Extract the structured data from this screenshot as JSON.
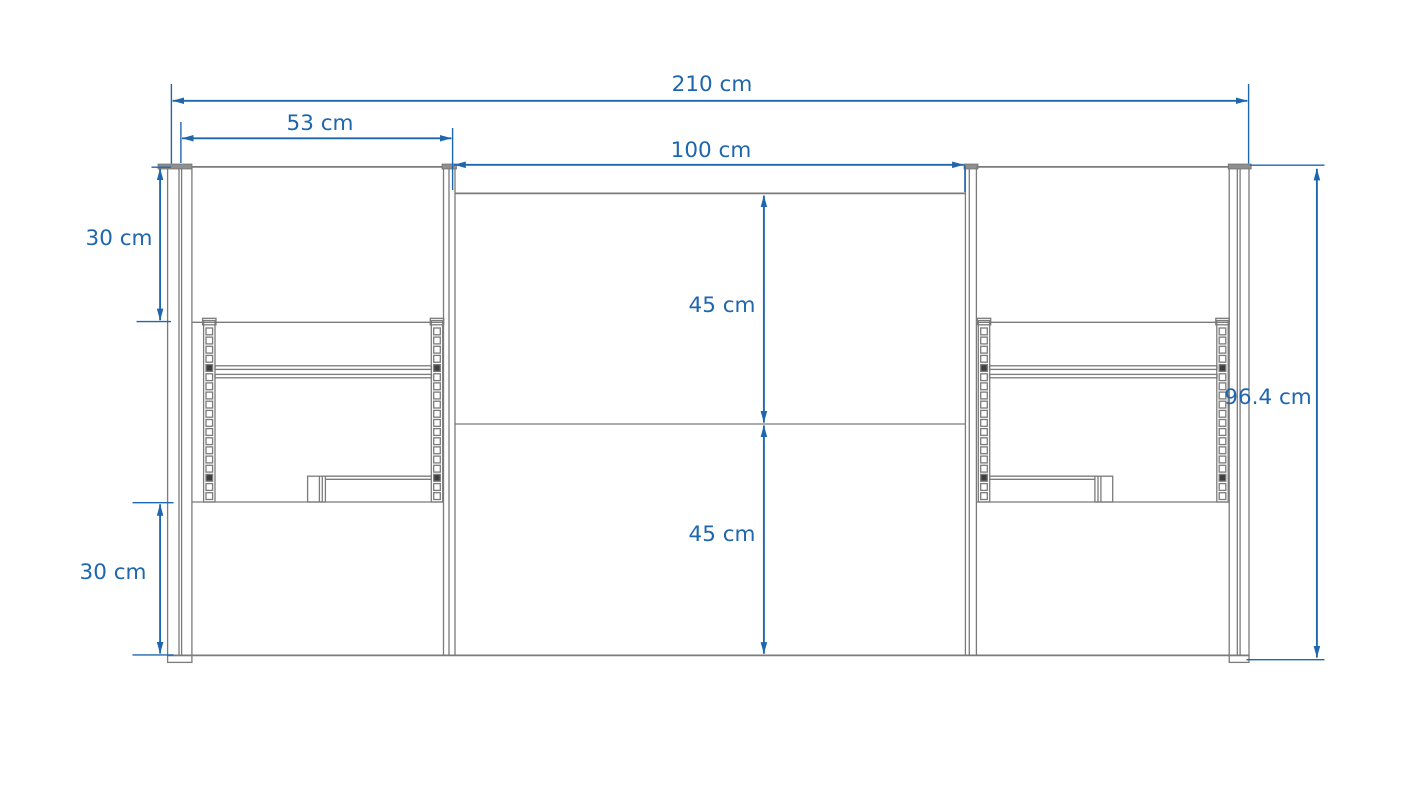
{
  "drawing": {
    "type": "furniture-elevation-technical-drawing",
    "unit": "cm",
    "colors": {
      "dimension_accent": "#1e66ad",
      "outline_gray": "#7b7b7b",
      "background": "#ffffff"
    },
    "dimensions": {
      "total_width": {
        "label": "210 cm",
        "value": 210
      },
      "left_section_width": {
        "label": "53 cm",
        "value": 53
      },
      "center_section_width": {
        "label": "100 cm",
        "value": 100
      },
      "left_upper_height": {
        "label": "30 cm",
        "value": 30
      },
      "left_lower_height": {
        "label": "30 cm",
        "value": 30
      },
      "center_upper_height": {
        "label": "45 cm",
        "value": 45
      },
      "center_lower_height": {
        "label": "45 cm",
        "value": 45
      },
      "total_height": {
        "label": "96.4 cm",
        "value": 96.4
      }
    }
  }
}
